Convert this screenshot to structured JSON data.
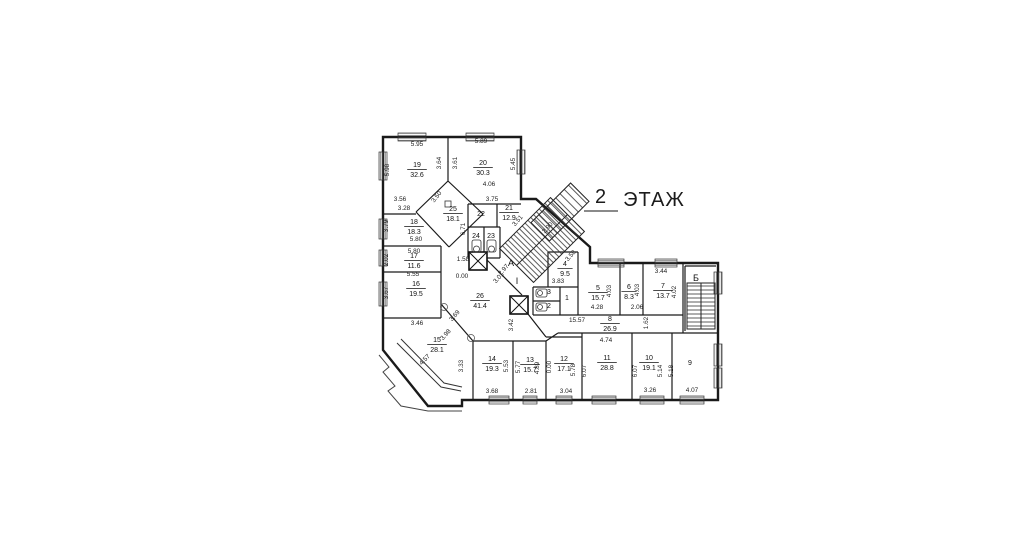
{
  "title": {
    "number": "2",
    "label": "ЭТАЖ"
  },
  "colors": {
    "background": "#ffffff",
    "line": "#1a1a1a",
    "text": "#111111",
    "underline": "#8a8a8a"
  },
  "marks": [
    {
      "label": "А",
      "x": 511,
      "y": 266
    },
    {
      "label": "Б",
      "x": 696,
      "y": 281
    },
    {
      "label": "I",
      "x": 517,
      "y": 284
    }
  ],
  "rooms": [
    {
      "number": "19",
      "area": "32.6",
      "x": 417,
      "y": 169
    },
    {
      "number": "20",
      "area": "30.3",
      "x": 483,
      "y": 167
    },
    {
      "number": "25",
      "area": "18.1",
      "x": 453,
      "y": 213
    },
    {
      "number": "22",
      "area": null,
      "x": 481,
      "y": 214
    },
    {
      "number": "21",
      "area": "12.9",
      "x": 509,
      "y": 212
    },
    {
      "number": "24",
      "area": null,
      "x": 476,
      "y": 236
    },
    {
      "number": "23",
      "area": null,
      "x": 491,
      "y": 236
    },
    {
      "number": "18",
      "area": "18.3",
      "x": 414,
      "y": 226
    },
    {
      "number": "17",
      "area": "11.6",
      "x": 414,
      "y": 260
    },
    {
      "number": "16",
      "area": "19.5",
      "x": 416,
      "y": 288
    },
    {
      "number": "15",
      "area": "28.1",
      "x": 437,
      "y": 344
    },
    {
      "number": "26",
      "area": "41.4",
      "x": 480,
      "y": 300
    },
    {
      "number": "14",
      "area": "19.3",
      "x": 492,
      "y": 363
    },
    {
      "number": "13",
      "area": "15.7",
      "x": 530,
      "y": 364
    },
    {
      "number": "12",
      "area": "17.1",
      "x": 564,
      "y": 363
    },
    {
      "number": "11",
      "area": "28.8",
      "x": 607,
      "y": 362
    },
    {
      "number": "10",
      "area": "19.1",
      "x": 649,
      "y": 362
    },
    {
      "number": "9",
      "area": null,
      "x": 690,
      "y": 363
    },
    {
      "number": "8",
      "area": "26.9",
      "x": 610,
      "y": 323
    },
    {
      "number": "5",
      "area": "15.7",
      "x": 598,
      "y": 292
    },
    {
      "number": "6",
      "area": "8.3",
      "x": 629,
      "y": 291
    },
    {
      "number": "7",
      "area": "13.7",
      "x": 663,
      "y": 290
    },
    {
      "number": "4",
      "area": "9.5",
      "x": 565,
      "y": 268
    },
    {
      "number": "3",
      "area": null,
      "x": 549,
      "y": 292
    },
    {
      "number": "2",
      "area": null,
      "x": 549,
      "y": 306
    },
    {
      "number": "1",
      "area": null,
      "x": 567,
      "y": 298
    }
  ],
  "dimensions": [
    {
      "t": "5.95",
      "x": 417,
      "y": 146
    },
    {
      "t": "5.89",
      "x": 481,
      "y": 143
    },
    {
      "t": "5.98",
      "x": 389,
      "y": 170,
      "r": -90
    },
    {
      "t": "3.64",
      "x": 441,
      "y": 163,
      "r": -90
    },
    {
      "t": "3.61",
      "x": 457,
      "y": 163,
      "r": -90
    },
    {
      "t": "5.45",
      "x": 515,
      "y": 164,
      "r": -90
    },
    {
      "t": "3.56",
      "x": 400,
      "y": 201
    },
    {
      "t": "3.28",
      "x": 404,
      "y": 210
    },
    {
      "t": "3.50",
      "x": 438,
      "y": 198,
      "r": -52
    },
    {
      "t": "4.06",
      "x": 489,
      "y": 186
    },
    {
      "t": "3.75",
      "x": 492,
      "y": 201
    },
    {
      "t": "3.79",
      "x": 388,
      "y": 226,
      "r": -90
    },
    {
      "t": "5.80",
      "x": 416,
      "y": 241
    },
    {
      "t": "5.80",
      "x": 414,
      "y": 253
    },
    {
      "t": "2.02",
      "x": 388,
      "y": 260,
      "r": -90
    },
    {
      "t": "5.55",
      "x": 413,
      "y": 276
    },
    {
      "t": "3.67",
      "x": 388,
      "y": 293,
      "r": -90
    },
    {
      "t": "6.71",
      "x": 465,
      "y": 229,
      "r": -90
    },
    {
      "t": "1.58",
      "x": 463,
      "y": 261
    },
    {
      "t": "0.00",
      "x": 462,
      "y": 278
    },
    {
      "t": "3.51",
      "x": 519,
      "y": 222,
      "r": -48
    },
    {
      "t": "2.90",
      "x": 549,
      "y": 229,
      "r": -48
    },
    {
      "t": "3.58",
      "x": 572,
      "y": 257,
      "r": -48
    },
    {
      "t": "2.97",
      "x": 505,
      "y": 271,
      "r": -48
    },
    {
      "t": "3.01",
      "x": 500,
      "y": 279,
      "r": -48
    },
    {
      "t": "3.83",
      "x": 558,
      "y": 283
    },
    {
      "t": "3.44",
      "x": 661,
      "y": 273
    },
    {
      "t": "4.03",
      "x": 611,
      "y": 291,
      "r": -90
    },
    {
      "t": "4.03",
      "x": 639,
      "y": 290,
      "r": -90
    },
    {
      "t": "4.02",
      "x": 676,
      "y": 292,
      "r": -90
    },
    {
      "t": "4.28",
      "x": 597,
      "y": 309
    },
    {
      "t": "2.06",
      "x": 637,
      "y": 309
    },
    {
      "t": "15.57",
      "x": 577,
      "y": 322
    },
    {
      "t": "1.62",
      "x": 648,
      "y": 323,
      "r": -90
    },
    {
      "t": "4.74",
      "x": 606,
      "y": 342
    },
    {
      "t": "3.42",
      "x": 513,
      "y": 325,
      "r": -90
    },
    {
      "t": "3.46",
      "x": 417,
      "y": 325
    },
    {
      "t": "3.69",
      "x": 456,
      "y": 317,
      "r": -48
    },
    {
      "t": "3.98",
      "x": 447,
      "y": 336,
      "r": -48
    },
    {
      "t": "4.57",
      "x": 426,
      "y": 361,
      "r": -45
    },
    {
      "t": "3.33",
      "x": 463,
      "y": 366,
      "r": -90
    },
    {
      "t": "5.53",
      "x": 508,
      "y": 366,
      "r": -90
    },
    {
      "t": "5.77",
      "x": 520,
      "y": 367,
      "r": -90
    },
    {
      "t": "4.89",
      "x": 539,
      "y": 368,
      "r": -90
    },
    {
      "t": "0.00",
      "x": 551,
      "y": 367,
      "r": -90
    },
    {
      "t": "5.78",
      "x": 575,
      "y": 370,
      "r": -90
    },
    {
      "t": "6.07",
      "x": 586,
      "y": 371,
      "r": -90
    },
    {
      "t": "6.07",
      "x": 637,
      "y": 371,
      "r": -90
    },
    {
      "t": "5.14",
      "x": 662,
      "y": 371,
      "r": -90
    },
    {
      "t": "5.18",
      "x": 673,
      "y": 371,
      "r": -90
    },
    {
      "t": "3.68",
      "x": 492,
      "y": 393
    },
    {
      "t": "2.81",
      "x": 531,
      "y": 393
    },
    {
      "t": "3.04",
      "x": 566,
      "y": 393
    },
    {
      "t": "3.26",
      "x": 650,
      "y": 392
    },
    {
      "t": "4.07",
      "x": 692,
      "y": 392
    }
  ]
}
